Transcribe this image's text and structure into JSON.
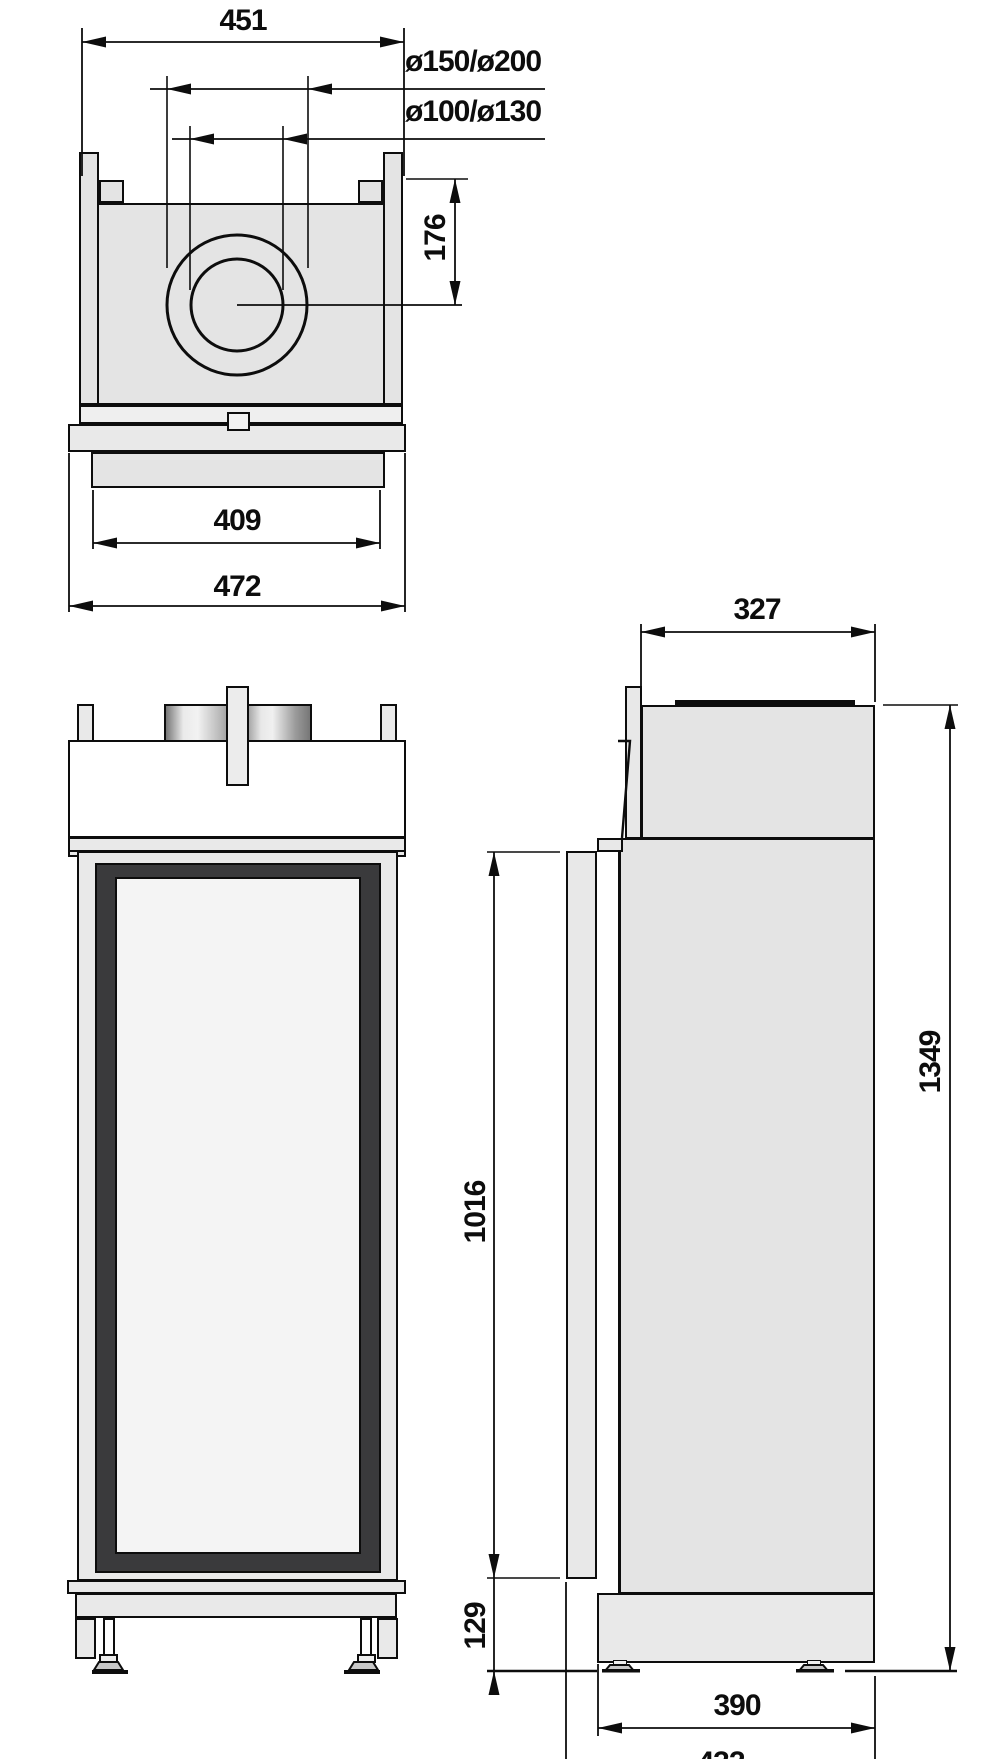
{
  "drawing": {
    "type": "technical-dimension-drawing",
    "views": [
      "top-view",
      "front-view",
      "side-view"
    ],
    "line_color": "#0d0d0d",
    "body_fill": "#e4e4e4",
    "dark_frame_fill": "#3a3a3c",
    "glass_fill": "#f4f4f4"
  },
  "dims": {
    "top_width": "451",
    "flue_diameters_outer": "ø150/ø200",
    "flue_diameters_inner": "ø100/ø130",
    "flue_offset": "176",
    "plate_width": "409",
    "overall_width": "472",
    "top_depth": "327",
    "door_height": "1016",
    "plinth_height": "129",
    "overall_height": "1349",
    "base_depth": "390",
    "overall_depth": "432"
  }
}
